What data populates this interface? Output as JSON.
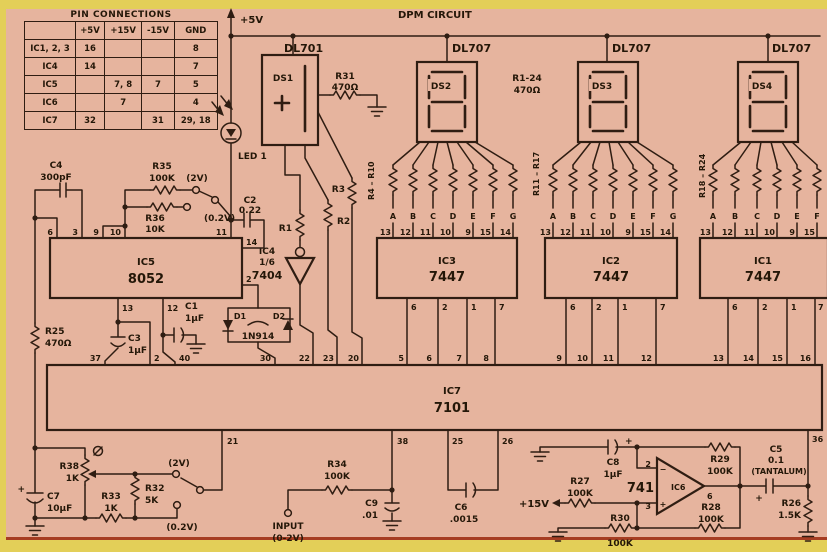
{
  "colors": {
    "paper": "#e6b49e",
    "border_band": "#e3cf58",
    "ink": "#2f1d12",
    "bottom_rule": "#a63d22"
  },
  "title": "DPM CIRCUIT",
  "pin_table": {
    "title": "PIN CONNECTIONS",
    "col_headers": [
      "+5V",
      "+15V",
      "-15V",
      "GND"
    ],
    "rows": [
      {
        "name": "IC1, 2, 3",
        "v5": "16",
        "v15": "",
        "vm15": "",
        "gnd": "8"
      },
      {
        "name": "IC4",
        "v5": "14",
        "v15": "",
        "vm15": "",
        "gnd": "7"
      },
      {
        "name": "IC5",
        "v5": "",
        "v15": "7, 8",
        "vm15": "7",
        "gnd": "5"
      },
      {
        "name": "IC6",
        "v5": "",
        "v15": "7",
        "vm15": "",
        "gnd": "4"
      },
      {
        "name": "IC7",
        "v5": "32",
        "v15": "",
        "vm15": "31",
        "gnd": "29, 18"
      }
    ]
  },
  "labels": {
    "title": "DPM CIRCUIT",
    "plus5": "+5V",
    "plus15": "+15V",
    "dl701": "DL701",
    "dl707": "DL707",
    "ds1": "DS1",
    "ds2": "DS2",
    "ds3": "DS3",
    "ds4": "DS4",
    "led1": "LED 1",
    "r31": "R31",
    "r470": "470Ω",
    "r1_24": "R1-24",
    "rg2": "R4 – R10",
    "rg3": "R11 – R17",
    "rg4": "R18 – R24",
    "ic1": "IC1",
    "ic2": "IC2",
    "ic3": "IC3",
    "p7447": "7447",
    "ic4": "IC4",
    "frac16": "1/6",
    "p7404": "7404",
    "ic5": "IC5",
    "p8052": "8052",
    "ic6": "IC6",
    "p741": "741",
    "ic7": "IC7",
    "p7101": "7101",
    "c4": "C4",
    "c4v": "300pF",
    "r35": "R35",
    "k100": "100K",
    "r36": "R36",
    "r36v": "10K",
    "v2": "(2V)",
    "v02": "(0.2V)",
    "c2": "C2",
    "c2v": "0.22",
    "r1": "R1",
    "r2": "R2",
    "r3": "R3",
    "d1": "D1",
    "d2": "D2",
    "d1n914": "1N914",
    "c1": "C1",
    "uf1": "1µF",
    "c3": "C3",
    "r25": "R25",
    "r38": "R38",
    "k1": "1K",
    "r33": "R33",
    "r32": "R32",
    "r32v": "5K",
    "c7": "C7",
    "c7v": "10µF",
    "r34": "R34",
    "c9": "C9",
    "c9v": ".01",
    "input": "INPUT",
    "inputv": "(0-2V)",
    "c6": "C6",
    "c6v": ".0015",
    "c8": "C8",
    "r27": "R27",
    "r30": "R30",
    "r29": "R29",
    "r28": "R28",
    "c5": "C5",
    "c5v": "0.1",
    "c5t": "(TANTALUM)",
    "r26": "R26",
    "r26v": "1.5K",
    "plus": "+",
    "minus": "−"
  },
  "segments": [
    "A",
    "B",
    "C",
    "D",
    "E",
    "F",
    "G"
  ],
  "pins": {
    "decoder_top": [
      "13",
      "12",
      "11",
      "10",
      "9",
      "15",
      "14"
    ],
    "decoder_bottom": [
      "6",
      "2",
      "1",
      "7"
    ],
    "ic7_top": [
      "37",
      "2",
      "40",
      "30",
      "22",
      "23",
      "20",
      "5",
      "6",
      "7",
      "8",
      "9",
      "10",
      "11",
      "12",
      "13",
      "14",
      "15",
      "16"
    ],
    "ic7_bottom": [
      "21",
      "38",
      "25",
      "26",
      "36"
    ],
    "ic5_top": [
      "6",
      "3",
      "9",
      "10",
      "11"
    ],
    "ic5_bottom": [
      "13",
      "12"
    ],
    "ic5_right": [
      "14",
      "2"
    ],
    "opamp": [
      "2",
      "3",
      "6"
    ]
  }
}
